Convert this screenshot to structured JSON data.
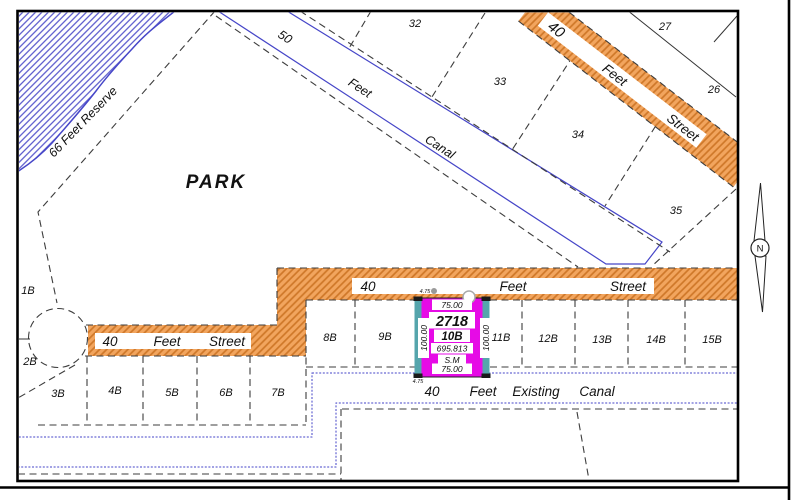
{
  "colors": {
    "street_orange": "#F2A55E",
    "street_hatch": "#CE7728",
    "canal_blue": "#4A4AC8",
    "selected_magenta": "#E60BE6",
    "handle_teal": "#55A5AC"
  },
  "park": {
    "label": "PARK"
  },
  "reserve": {
    "label": "66 Feet Reserve"
  },
  "canal50": {
    "width": "50",
    "feet": "Feet",
    "name": "Canal"
  },
  "street_diag": {
    "width": "40",
    "feet": "Feet",
    "name": "Street"
  },
  "street_upper": {
    "width": "40",
    "feet": "Feet",
    "name": "Street"
  },
  "street_lower": {
    "width": "40",
    "feet": "Feet",
    "name": "Street"
  },
  "canal_exist": {
    "width": "40",
    "feet": "Feet",
    "qualifier": "Existing",
    "name": "Canal"
  },
  "north": {
    "label": "N"
  },
  "lots": {
    "n32": "32",
    "n33": "33",
    "n34": "34",
    "n35": "35",
    "n27": "27",
    "n26": "26",
    "b1": "1B",
    "b2": "2B",
    "b3": "3B",
    "b4": "4B",
    "b5": "5B",
    "b6": "6B",
    "b7": "7B",
    "b8": "8B",
    "b9": "9B",
    "b11": "11B",
    "b12": "12B",
    "b13": "13B",
    "b14": "14B",
    "b15": "15B"
  },
  "sel": {
    "parcel": "2718",
    "lot": "10B",
    "area": "695.813",
    "unit": "S.M",
    "top": "75.00",
    "bottom": "75.00",
    "left": "100.00",
    "right": "100.00",
    "off_top": "4.75",
    "off_bottom": "4.75"
  }
}
